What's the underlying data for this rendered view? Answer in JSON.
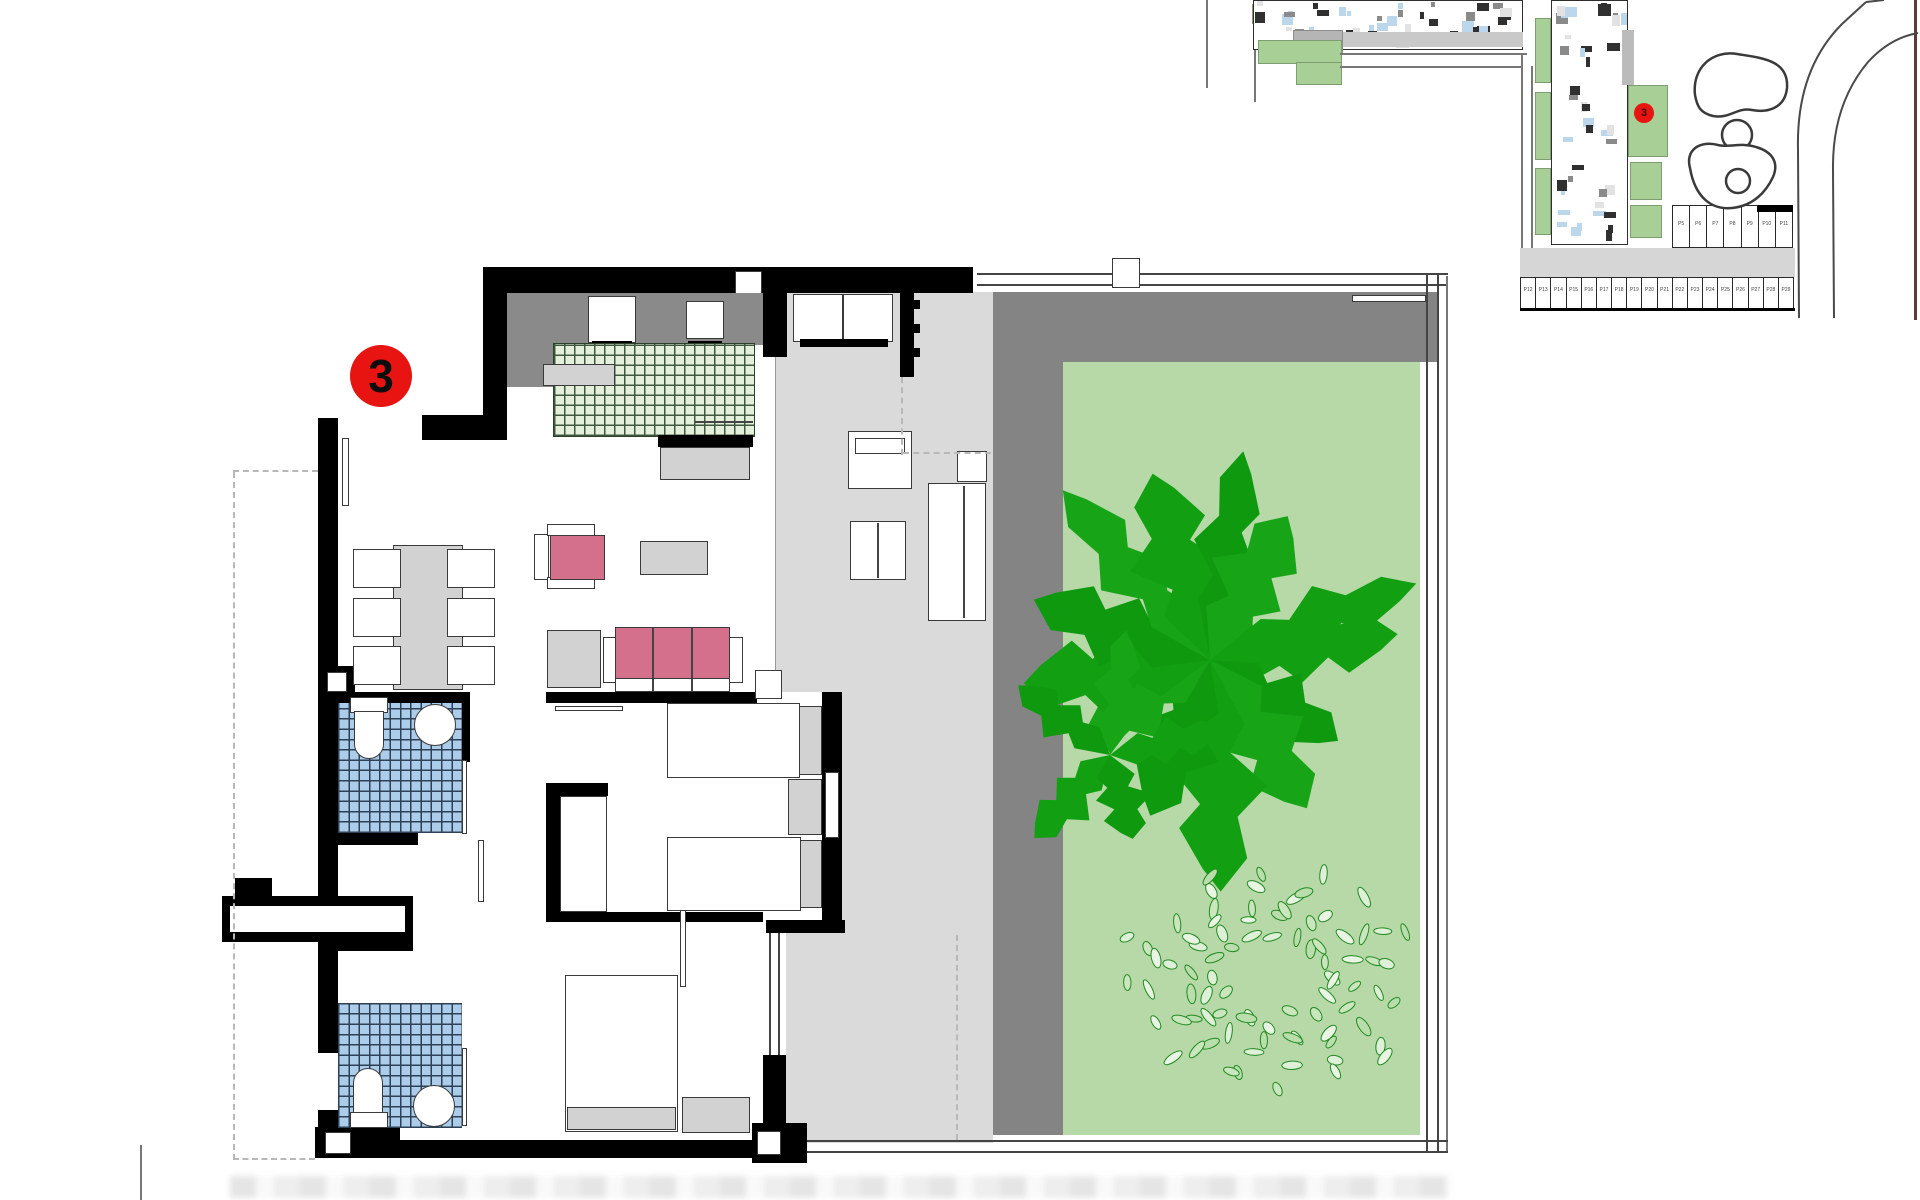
{
  "badge": {
    "label": "3"
  },
  "site_plan": {
    "unit_marker_label": "3",
    "parking_top_labels": [
      "P5",
      "P6",
      "P7",
      "P8",
      "P9",
      "P10",
      "P11"
    ],
    "parking_bottom_labels": [
      "P12",
      "P13",
      "P14",
      "P15",
      "P16",
      "P17",
      "P18",
      "P19",
      "P20",
      "P21",
      "P22",
      "P23",
      "P24",
      "P25",
      "P26",
      "P27",
      "P28",
      "P29"
    ]
  },
  "colors": {
    "wall": "#000000",
    "badge_red": "#e81412",
    "lawn_green": "#b7d9a8",
    "tree_green": "#12a012",
    "tile_green": "#e4efdc",
    "tile_blue": "#abcde9",
    "accent_pink": "#d4708c",
    "deck_dark_gray": "#848484",
    "floor_light_gray": "#dadada",
    "site_green": "#a8cf96",
    "site_blue": "#b8d4ea"
  }
}
